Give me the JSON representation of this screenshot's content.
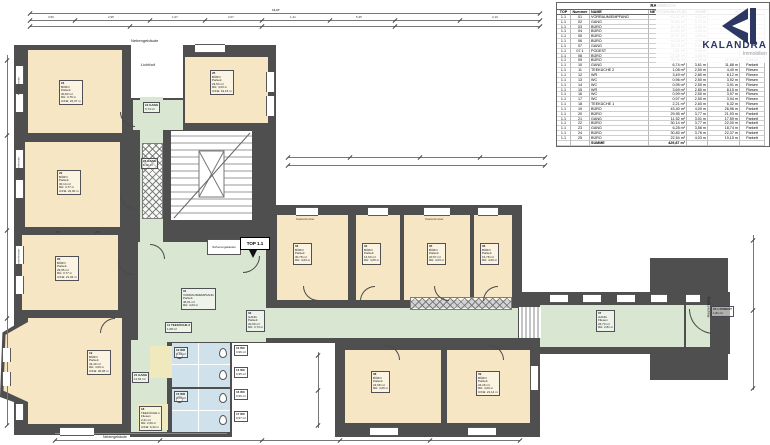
{
  "logo": {
    "brand": "KALANDRA",
    "sub": "Immobilien",
    "navy": "#2c3763",
    "gray": "#989ca6"
  },
  "raumbuch": {
    "title": "RAUMBUCH",
    "headers": [
      "TOP",
      "Nummer",
      "NAME",
      "NETTOGRUND-FLÄCHE",
      "HÖHE",
      "N",
      ""
    ],
    "rows": [
      [
        "1.1",
        "01",
        "VORRAUM/EMPFANG",
        "45,01 m²",
        "4,03 m",
        "",
        ""
      ],
      [
        "1.1",
        "02",
        "GANG",
        "30,69 m²",
        "3,73 m",
        "",
        ""
      ],
      [
        "1.1",
        "03",
        "BÜRO",
        "30,78 m²",
        "4,03 m",
        "",
        ""
      ],
      [
        "1.1",
        "04",
        "BÜRO",
        "14,60 m²",
        "4,05 m",
        "",
        ""
      ],
      [
        "1.1",
        "05",
        "BÜRO",
        "20,57 m²",
        "4,03 m",
        "",
        ""
      ],
      [
        "1.1",
        "06",
        "BÜRO",
        "16,78 m²",
        "4,00 m",
        "",
        ""
      ],
      [
        "1.1",
        "07",
        "GANG",
        "26,70 m²",
        "2,81 m",
        "",
        ""
      ],
      [
        "1.1",
        "07.1",
        "PODEST",
        "1,81 m²",
        "2,16 m",
        "",
        ""
      ],
      [
        "1.1",
        "08",
        "BÜRO",
        "22,68 m²",
        "4,06 m",
        "",
        ""
      ],
      [
        "1.1",
        "09",
        "BÜRO",
        "26,26 m²",
        "4,00 m",
        "21,14 m",
        "Parkett"
      ],
      [
        "1.1",
        "10",
        "GANG",
        "6,74 m²",
        "3,61 m",
        "11,88 m",
        "Parkett"
      ],
      [
        "1.1",
        "11",
        "TEEKÜCHE 2",
        "1,08 m²",
        "2,50 m",
        "4,40 m",
        "Fliesen"
      ],
      [
        "1.1",
        "12",
        "WR",
        "3,49 m²",
        "2,80 m",
        "8,12 m",
        "Fliesen"
      ],
      [
        "1.1",
        "13",
        "WC",
        "0,96 m²",
        "2,50 m",
        "3,92 m",
        "Fliesen"
      ],
      [
        "1.1",
        "14",
        "WC",
        "0,95 m²",
        "2,50 m",
        "3,91 m",
        "Fliesen"
      ],
      [
        "1.1",
        "15",
        "WR",
        "3,69 m²",
        "2,80 m",
        "8,15 m",
        "Fliesen"
      ],
      [
        "1.1",
        "16",
        "WC",
        "0,99 m²",
        "2,50 m",
        "3,97 m",
        "Fliesen"
      ],
      [
        "1.1",
        "17",
        "WC",
        "0,97 m²",
        "2,50 m",
        "3,94 m",
        "Fliesen"
      ],
      [
        "1.1",
        "18",
        "TEEKÜCHE 1",
        "2,21 m²",
        "2,60 m",
        "6,32 m",
        "Fliesen"
      ],
      [
        "1.1",
        "19",
        "BÜRO",
        "43,40 m²",
        "4,00 m",
        "26,96 m",
        "Parkett"
      ],
      [
        "1.1",
        "20",
        "BÜRO",
        "29,95 m²",
        "3,77 m",
        "21,93 m",
        "Parkett"
      ],
      [
        "1.1",
        "21",
        "GANG",
        "11,52 m²",
        "3,01 m",
        "17,59 m",
        "Parkett"
      ],
      [
        "1.1",
        "22",
        "BÜRO",
        "30,14 m²",
        "3,77 m",
        "22,00 m",
        "Parkett"
      ],
      [
        "1.1",
        "23",
        "GANG",
        "6,28 m²",
        "3,56 m",
        "18,74 m",
        "Parkett"
      ],
      [
        "1.1",
        "24",
        "BÜRO",
        "30,83 m²",
        "3,76 m",
        "22,37 m",
        "Parkett"
      ],
      [
        "1.1",
        "25",
        "BÜRO",
        "22,54 m²",
        "4,03 m",
        "19,15 m",
        "Parkett"
      ]
    ],
    "sum_label": "SUMME",
    "sum_value": "429,87 m²"
  },
  "plan": {
    "colors": {
      "wall": "#4f4f4f",
      "office": "#f6e6c3",
      "corridor": "#d9e7d2",
      "wc": "#cfe2ec",
      "kitchen": "#efe9bd",
      "white": "#ffffff"
    },
    "rooms": [
      {
        "id": "01",
        "nr": "01",
        "name": "VORRAUM/EMPFANG",
        "belag": "Parkett",
        "area": "45,01 m²",
        "rh": "RH: 4,03 m",
        "u": ""
      },
      {
        "id": "02",
        "nr": "02",
        "name": "GANG",
        "belag": "Parkett",
        "area": "30,69 m²",
        "rh": "RH: 3,73 m",
        "u": ""
      },
      {
        "id": "03",
        "nr": "03",
        "name": "BÜRO",
        "belag": "Parkett",
        "area": "30,78 m²",
        "rh": "RH: 4,03 m",
        "u": ""
      },
      {
        "id": "04",
        "nr": "04",
        "name": "BÜRO",
        "belag": "Parkett",
        "area": "14,60 m²",
        "rh": "RH: 4,05 m",
        "u": ""
      },
      {
        "id": "05",
        "nr": "05",
        "name": "BÜRO",
        "belag": "Parkett",
        "area": "20,57 m²",
        "rh": "RH: 4,03 m",
        "u": ""
      },
      {
        "id": "06",
        "nr": "06",
        "name": "BÜRO",
        "belag": "Parkett",
        "area": "16,78 m²",
        "rh": "RH: 4,00 m",
        "u": ""
      },
      {
        "id": "07",
        "nr": "07",
        "name": "GANG",
        "belag": "Fliesen",
        "area": "26,70 m²",
        "rh": "RH: 2,81 m",
        "u": ""
      },
      {
        "id": "07.1",
        "nr": "07.1",
        "name": "PODEST",
        "belag": "Fliesen",
        "area": "1,81 m²",
        "rh": "RH: 2,16 m",
        "u": ""
      },
      {
        "id": "08",
        "nr": "08",
        "name": "BÜRO",
        "belag": "Parkett",
        "area": "22,68 m²",
        "rh": "RH: 4,06 m",
        "u": ""
      },
      {
        "id": "09",
        "nr": "09",
        "name": "BÜRO",
        "belag": "Parkett",
        "area": "26,26 m²",
        "rh": "RH: 4,00 m",
        "u": "U/Flä: 21,14 m"
      },
      {
        "id": "10",
        "nr": "10",
        "name": "GANG",
        "belag": "Parkett",
        "area": "6,74 m²",
        "rh": "RH: 3,61 m",
        "u": "U/Flä: 11,88 m"
      },
      {
        "id": "11",
        "nr": "11",
        "name": "TEEKÜCHE 2",
        "belag": "Fliesen",
        "area": "1,08 m²",
        "rh": "RH: 2,50 m",
        "u": "U/Flä: 4,40 m"
      },
      {
        "id": "12",
        "nr": "12",
        "name": "WR",
        "belag": "Fliesen",
        "area": "3,49 m²",
        "rh": "RH: 2,80 m",
        "u": "U/Flä: 8,12 m"
      },
      {
        "id": "13",
        "nr": "13",
        "name": "WC",
        "belag": "Fliesen",
        "area": "0,96 m²",
        "rh": "RH: 2,50 m",
        "u": "U/Flä: 3,92 m"
      },
      {
        "id": "14",
        "nr": "14",
        "name": "WC",
        "belag": "Fliesen",
        "area": "0,95 m²",
        "rh": "RH: 2,50 m",
        "u": "U/Flä: 3,91 m"
      },
      {
        "id": "15",
        "nr": "15",
        "name": "WR",
        "belag": "Fliesen",
        "area": "3,69 m²",
        "rh": "RH: 2,80 m",
        "u": "U/Flä: 8,15 m"
      },
      {
        "id": "16",
        "nr": "16",
        "name": "WC",
        "belag": "Fliesen",
        "area": "0,99 m²",
        "rh": "RH: 2,50 m",
        "u": "U/Flä: 3,97 m"
      },
      {
        "id": "17",
        "nr": "17",
        "name": "WC",
        "belag": "Fliesen",
        "area": "0,97 m²",
        "rh": "RH: 2,50 m",
        "u": "U/Flä: 3,94 m"
      },
      {
        "id": "18",
        "nr": "18",
        "name": "TEEKÜCHE 1",
        "belag": "Fliesen",
        "area": "2,21 m²",
        "rh": "RH: 2,60 m",
        "u": "U/Flä: 6,32 m"
      },
      {
        "id": "19",
        "nr": "19",
        "name": "BÜRO",
        "belag": "Parkett",
        "area": "43,40 m²",
        "rh": "RH: 4,00 m",
        "u": "U/Flä: 26,96 m"
      },
      {
        "id": "20",
        "nr": "20",
        "name": "BÜRO",
        "belag": "Parkett",
        "area": "29,95 m²",
        "rh": "RH: 3,77 m",
        "u": "U/Flä: 21,93 m"
      },
      {
        "id": "21",
        "nr": "21",
        "name": "GANG",
        "belag": "Parkett",
        "area": "11,52 m²",
        "rh": "RH: 3,01 m",
        "u": "U/Flä: 17,59 m"
      },
      {
        "id": "22",
        "nr": "22",
        "name": "BÜRO",
        "belag": "Parkett",
        "area": "30,14 m²",
        "rh": "RH: 3,77 m",
        "u": "U/Flä: 22,00 m"
      },
      {
        "id": "23",
        "nr": "23",
        "name": "GANG",
        "belag": "Parkett",
        "area": "6,28 m²",
        "rh": "RH: 3,56 m",
        "u": "U/Flä: 18,74 m"
      },
      {
        "id": "24",
        "nr": "24",
        "name": "BÜRO",
        "belag": "Parkett",
        "area": "30,83 m²",
        "rh": "RH: 3,76 m",
        "u": "U/Flä: 22,37 m"
      },
      {
        "id": "25",
        "nr": "25",
        "name": "BÜRO",
        "belag": "Parkett",
        "area": "22,54 m²",
        "rh": "RH: 4,03 m",
        "u": "U/Flä: 19,15 m"
      }
    ],
    "texts": {
      "top_marker": "TOP 1.1",
      "fuse_box": "Sicherungskasten",
      "lichthof": "Lichthof",
      "annex": "Nebengebäude",
      "entrance": "Hauseingang",
      "window_label": "Kastenfenster"
    },
    "dims": {
      "total": "14,07",
      "segments": [
        "3,50",
        "2,95",
        "1,07",
        "2,07",
        "1,41",
        "5,35",
        "2,10"
      ],
      "interior": [
        "350",
        "295"
      ]
    }
  }
}
